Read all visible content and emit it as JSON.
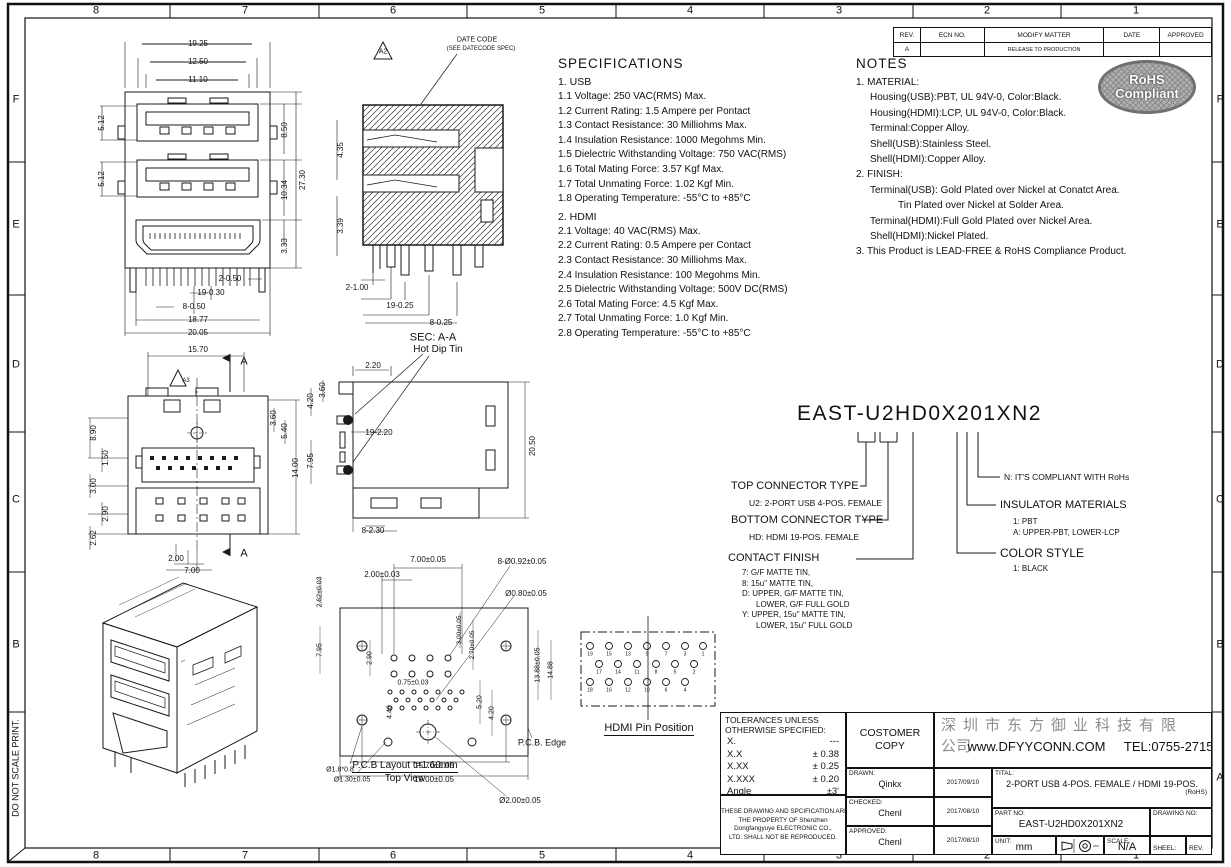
{
  "border": {
    "do_not_scale": "DO NOT SCALE PRINT.",
    "labels": [
      {
        "t": "8",
        "x": 96,
        "y": 11,
        "fs": 11
      },
      {
        "t": "7",
        "x": 245,
        "y": 11,
        "fs": 11
      },
      {
        "t": "6",
        "x": 393,
        "y": 11,
        "fs": 11
      },
      {
        "t": "5",
        "x": 542,
        "y": 11,
        "fs": 11
      },
      {
        "t": "4",
        "x": 690,
        "y": 11,
        "fs": 11
      },
      {
        "t": "3",
        "x": 839,
        "y": 11,
        "fs": 11
      },
      {
        "t": "2",
        "x": 987,
        "y": 11,
        "fs": 11
      },
      {
        "t": "1",
        "x": 1136,
        "y": 11,
        "fs": 11
      },
      {
        "t": "8",
        "x": 96,
        "y": 856,
        "fs": 11
      },
      {
        "t": "7",
        "x": 245,
        "y": 856,
        "fs": 11
      },
      {
        "t": "6",
        "x": 393,
        "y": 856,
        "fs": 11
      },
      {
        "t": "5",
        "x": 542,
        "y": 856,
        "fs": 11
      },
      {
        "t": "4",
        "x": 690,
        "y": 856,
        "fs": 11
      },
      {
        "t": "3",
        "x": 839,
        "y": 856,
        "fs": 11
      },
      {
        "t": "2",
        "x": 987,
        "y": 856,
        "fs": 11
      },
      {
        "t": "1",
        "x": 1136,
        "y": 856,
        "fs": 11
      },
      {
        "t": "F",
        "x": 16,
        "y": 100,
        "fs": 11
      },
      {
        "t": "E",
        "x": 16,
        "y": 225,
        "fs": 11
      },
      {
        "t": "D",
        "x": 16,
        "y": 365,
        "fs": 11
      },
      {
        "t": "C",
        "x": 16,
        "y": 500,
        "fs": 11
      },
      {
        "t": "B",
        "x": 16,
        "y": 645,
        "fs": 11
      },
      {
        "t": "F",
        "x": 1220,
        "y": 100,
        "fs": 11
      },
      {
        "t": "E",
        "x": 1220,
        "y": 225,
        "fs": 11
      },
      {
        "t": "D",
        "x": 1220,
        "y": 365,
        "fs": 11
      },
      {
        "t": "C",
        "x": 1220,
        "y": 500,
        "fs": 11
      },
      {
        "t": "B",
        "x": 1220,
        "y": 645,
        "fs": 11
      },
      {
        "t": "A",
        "x": 1220,
        "y": 778,
        "fs": 11
      },
      {
        "t": "DO NOT SCALE PRINT.",
        "x": 16,
        "y": 768,
        "r": -90,
        "fs": 9
      }
    ]
  },
  "revision_table": {
    "headers": [
      "REV.",
      "ECN NO.",
      "MODIFY  MATTER",
      "DATE",
      "APPROVED"
    ],
    "row": {
      "rev": "A",
      "ecn": "",
      "matter": "RELEASE TO PRODUCTION",
      "date": "",
      "approved": ""
    }
  },
  "specifications": {
    "title": "SPECIFICATIONS",
    "sections": [
      {
        "heading": "1. USB",
        "items": [
          "1.1 Voltage: 250 VAC(RMS) Max.",
          "1.2 Current Rating: 1.5 Ampere per Pontact",
          "1.3 Contact Resistance: 30 Milliohms Max.",
          "1.4 Insulation Resistance: 1000 Megohms Min.",
          "1.5 Dielectric Withstanding Voltage: 750 VAC(RMS)",
          "1.6 Total Mating Force: 3.57 Kgf Max.",
          "1.7 Total Unmating Force: 1.02 Kgf Min.",
          "1.8 Operating Temperature: -55°C to +85°C"
        ]
      },
      {
        "heading": "2. HDMI",
        "items": [
          "2.1 Voltage: 40 VAC(RMS) Max.",
          "2.2 Current Rating: 0.5 Ampere per Contact",
          "2.3 Contact Resistance: 30 Milliohms Max.",
          "2.4 Insulation Resistance: 100 Megohms Min.",
          "2.5 Dielectric Withstanding Voltage: 500V DC(RMS)",
          "2.6 Total Mating Force: 4.5 Kgf Max.",
          "2.7 Total Unmating Force: 1.0 Kgf Min.",
          "2.8 Operating Temperature: -55°C to +85°C"
        ]
      }
    ]
  },
  "notes": {
    "title": "NOTES",
    "items": [
      {
        "t": "1. MATERIAL:",
        "ind": 0
      },
      {
        "t": "Housing(USB):PBT, UL 94V-0, Color:Black.",
        "ind": 1
      },
      {
        "t": "Housing(HDMI):LCP, UL 94V-0, Color:Black.",
        "ind": 1
      },
      {
        "t": "Terminal:Copper Alloy.",
        "ind": 1
      },
      {
        "t": "Shell(USB):Stainless Steel.",
        "ind": 1
      },
      {
        "t": "Shell(HDMI):Copper Alloy.",
        "ind": 1
      },
      {
        "t": "2. FINISH:",
        "ind": 0
      },
      {
        "t": "Terminal(USB):  Gold Plated over Nickel at Conatct Area.",
        "ind": 1
      },
      {
        "t": "Tin Plated over Nickel at Solder Area.",
        "ind": 3
      },
      {
        "t": "Terminal(HDMI):Full Gold Plated over Nickel Area.",
        "ind": 1
      },
      {
        "t": "Shell(HDMI):Nickel Plated.",
        "ind": 1
      },
      {
        "t": "3. This Product is LEAD-FREE & RoHS Compliance Product.",
        "ind": 0
      }
    ]
  },
  "rohs_stamp": {
    "line1": "RoHS",
    "line2": "Compliant"
  },
  "part_number": {
    "value": "EAST-U2HD0X201XN2",
    "top_connector": {
      "label": "TOP CONNECTOR TYPE",
      "detail": "U2: 2-PORT USB 4-POS. FEMALE"
    },
    "bottom_connector": {
      "label": "BOTTOM CONNECTOR TYPE",
      "detail": "HD: HDMI 19-POS. FEMALE"
    },
    "contact_finish": {
      "label": "CONTACT FINISH",
      "options": [
        {
          "t": "7: G/F MATTE TIN,",
          "ind": 0
        },
        {
          "t": "8: 15u\" MATTE TIN,",
          "ind": 0
        },
        {
          "t": "D: UPPER, G/F MATTE TIN,",
          "ind": 0
        },
        {
          "t": "LOWER, G/F FULL GOLD",
          "ind": 1
        },
        {
          "t": "Y: UPPER, 15u\" MATTE TIN,",
          "ind": 0
        },
        {
          "t": "LOWER, 15u\" FULL GOLD",
          "ind": 1
        }
      ]
    },
    "rohs_note": "N: IT'S COMPLIANT WITH RoHs",
    "insulator": {
      "label": "INSULATOR MATERIALS",
      "options": [
        {
          "t": "1: PBT",
          "ind": 0
        },
        {
          "t": "A: UPPER-PBT, LOWER-LCP",
          "ind": 0
        }
      ]
    },
    "color_style": {
      "label": "COLOR STYLE",
      "options": [
        {
          "t": "1: BLACK",
          "ind": 0
        }
      ]
    }
  },
  "views": {
    "front": {
      "dims": [
        {
          "t": "19.25",
          "x": 118,
          "y": 14
        },
        {
          "t": "12.50",
          "x": 118,
          "y": 32
        },
        {
          "t": "11.10",
          "x": 118,
          "y": 50
        },
        {
          "t": "5.12",
          "x": 22,
          "y": 93,
          "r": -90
        },
        {
          "t": "5.12",
          "x": 22,
          "y": 149,
          "r": -90
        },
        {
          "t": "8.50",
          "x": 205,
          "y": 100,
          "r": -90
        },
        {
          "t": "10.34",
          "x": 205,
          "y": 160,
          "r": -90
        },
        {
          "t": "3.33",
          "x": 205,
          "y": 216,
          "r": -90
        },
        {
          "t": "27.30",
          "x": 223,
          "y": 150,
          "r": -90
        },
        {
          "t": "2-0.50",
          "x": 150,
          "y": 249
        },
        {
          "t": "19-0.30",
          "x": 131,
          "y": 263
        },
        {
          "t": "8-0.50",
          "x": 114,
          "y": 277
        },
        {
          "t": "18.77",
          "x": 118,
          "y": 290
        },
        {
          "t": "20.05",
          "x": 118,
          "y": 303
        }
      ]
    },
    "section": {
      "dims": [
        {
          "t": "A2",
          "x": 58,
          "y": 22,
          "fs": 7
        },
        {
          "t": "DATE CODE",
          "x": 152,
          "y": 10,
          "fs": 7
        },
        {
          "t": "(SEE DATECODE SPEC)",
          "x": 156,
          "y": 19,
          "fs": 6
        },
        {
          "t": "4.35",
          "x": 16,
          "y": 120,
          "r": -90
        },
        {
          "t": "3.39",
          "x": 16,
          "y": 196,
          "r": -90
        },
        {
          "t": "2-1.00",
          "x": 32,
          "y": 258
        },
        {
          "t": "19-0.25",
          "x": 75,
          "y": 276
        },
        {
          "t": "8-0.25",
          "x": 116,
          "y": 293
        },
        {
          "t": "SEC: A-A",
          "x": 108,
          "y": 308,
          "fs": 11
        }
      ]
    },
    "rear": {
      "dims": [
        {
          "t": "15.70",
          "x": 120,
          "y": 12
        },
        {
          "t": "A",
          "x": 166,
          "y": 24,
          "fs": 11
        },
        {
          "t": "A",
          "x": 166,
          "y": 216,
          "fs": 11
        },
        {
          "t": "A3",
          "x": 108,
          "y": 43,
          "fs": 6
        },
        {
          "t": "8.90",
          "x": 16,
          "y": 95,
          "r": -90
        },
        {
          "t": "1.50",
          "x": 28,
          "y": 120,
          "r": -90
        },
        {
          "t": "3.00",
          "x": 16,
          "y": 148,
          "r": -90
        },
        {
          "t": "2.90",
          "x": 28,
          "y": 176,
          "r": -90
        },
        {
          "t": "2.62",
          "x": 16,
          "y": 200,
          "r": -90
        },
        {
          "t": "3.60",
          "x": 196,
          "y": 80,
          "r": -90
        },
        {
          "t": "5.40",
          "x": 207,
          "y": 93,
          "r": -90
        },
        {
          "t": "14.00",
          "x": 218,
          "y": 130,
          "r": -90
        },
        {
          "t": "2.00",
          "x": 98,
          "y": 221
        },
        {
          "t": "7.00",
          "x": 114,
          "y": 233
        }
      ]
    },
    "side": {
      "dims": [
        {
          "t": "Hot Dip Tin",
          "x": 145,
          "y": 10,
          "fs": 10
        },
        {
          "t": "2.20",
          "x": 80,
          "y": 26
        },
        {
          "t": "3.60",
          "x": 30,
          "y": 50,
          "r": -90
        },
        {
          "t": "4.20",
          "x": 18,
          "y": 61,
          "r": -90
        },
        {
          "t": "19-2.20",
          "x": 86,
          "y": 93
        },
        {
          "t": "7.95",
          "x": 18,
          "y": 121,
          "r": -90
        },
        {
          "t": "20.50",
          "x": 240,
          "y": 106,
          "r": -90
        },
        {
          "t": "8-2.30",
          "x": 80,
          "y": 191
        }
      ]
    },
    "pcb": {
      "dims": [
        {
          "t": "7.00±0.05",
          "x": 118,
          "y": 10,
          "fs": 8
        },
        {
          "t": "2.00±0.03",
          "x": 72,
          "y": 25,
          "fs": 8
        },
        {
          "t": "8-Ø0.92±0.05",
          "x": 212,
          "y": 12,
          "fs": 8
        },
        {
          "t": "Ø0.80±0.05",
          "x": 216,
          "y": 44,
          "fs": 8
        },
        {
          "t": "2.62±0.03",
          "x": 10,
          "y": 42,
          "r": -90,
          "fs": 7
        },
        {
          "t": "7.95",
          "x": 10,
          "y": 100,
          "r": -90,
          "fs": 7
        },
        {
          "t": "2.90",
          "x": 60,
          "y": 108,
          "r": -90,
          "fs": 7
        },
        {
          "t": "3.00±0.05",
          "x": 150,
          "y": 80,
          "r": -90,
          "fs": 6.5
        },
        {
          "t": "2.70±0.05",
          "x": 163,
          "y": 95,
          "r": -90,
          "fs": 6.5
        },
        {
          "t": "0.75±0.03",
          "x": 103,
          "y": 133,
          "fs": 7
        },
        {
          "t": "4.40",
          "x": 80,
          "y": 162,
          "r": -90,
          "fs": 7
        },
        {
          "t": "13.88±0.05",
          "x": 228,
          "y": 115,
          "r": -90,
          "fs": 7
        },
        {
          "t": "14.88",
          "x": 241,
          "y": 120,
          "r": -90,
          "fs": 7
        },
        {
          "t": "5.20",
          "x": 170,
          "y": 152,
          "r": -90,
          "fs": 7
        },
        {
          "t": "4.20",
          "x": 182,
          "y": 163,
          "r": -90,
          "fs": 7
        },
        {
          "t": "15.70±0.05",
          "x": 124,
          "y": 216,
          "fs": 8
        },
        {
          "t": "19.00±0.05",
          "x": 124,
          "y": 230,
          "fs": 8
        },
        {
          "t": "Ø2.00±0.05",
          "x": 210,
          "y": 251,
          "fs": 8
        },
        {
          "t": "Ø1.8*0.8",
          "x": 30,
          "y": 220,
          "fs": 7
        },
        {
          "t": "Ø1.30±0.05",
          "x": 42,
          "y": 230,
          "fs": 7
        },
        {
          "t": "P.C.B. Edge",
          "x": 232,
          "y": 193,
          "fs": 9
        }
      ],
      "caption_line1": "P.C.B Layout t=1.60mm",
      "caption_line2": "Top View"
    },
    "hdmi_pins": {
      "dims": [
        {
          "t": "19",
          "x": 17,
          "y": 45,
          "fs": 5
        },
        {
          "t": "15",
          "x": 36,
          "y": 45,
          "fs": 5
        },
        {
          "t": "13",
          "x": 55,
          "y": 45,
          "fs": 5
        },
        {
          "t": "9",
          "x": 74,
          "y": 45,
          "fs": 5
        },
        {
          "t": "7",
          "x": 93,
          "y": 45,
          "fs": 5
        },
        {
          "t": "3",
          "x": 112,
          "y": 45,
          "fs": 5
        },
        {
          "t": "1",
          "x": 130,
          "y": 45,
          "fs": 5
        },
        {
          "t": "17",
          "x": 26,
          "y": 63,
          "fs": 5
        },
        {
          "t": "14",
          "x": 45,
          "y": 63,
          "fs": 5
        },
        {
          "t": "11",
          "x": 64,
          "y": 63,
          "fs": 5
        },
        {
          "t": "8",
          "x": 83,
          "y": 63,
          "fs": 5
        },
        {
          "t": "5",
          "x": 102,
          "y": 63,
          "fs": 5
        },
        {
          "t": "2",
          "x": 121,
          "y": 63,
          "fs": 5
        },
        {
          "t": "18",
          "x": 17,
          "y": 81,
          "fs": 5
        },
        {
          "t": "16",
          "x": 36,
          "y": 81,
          "fs": 5
        },
        {
          "t": "12",
          "x": 55,
          "y": 81,
          "fs": 5
        },
        {
          "t": "10",
          "x": 74,
          "y": 81,
          "fs": 5
        },
        {
          "t": "6",
          "x": 93,
          "y": 81,
          "fs": 5
        },
        {
          "t": "4",
          "x": 112,
          "y": 81,
          "fs": 5
        }
      ],
      "caption": "HDMI Pin Position"
    }
  },
  "title_block": {
    "tolerances": {
      "title_line1": "TOLERANCES UNLESS",
      "title_line2": "OTHERWISE SPECIFIED:",
      "rows": [
        {
          "k": "X.",
          "v": "---"
        },
        {
          "k": "X.X",
          "v": "± 0.38"
        },
        {
          "k": "X.XX",
          "v": "± 0.25"
        },
        {
          "k": "X.XXX",
          "v": "± 0.20"
        },
        {
          "k": "Angle",
          "v": "±3'"
        }
      ]
    },
    "property_note": [
      "THESE DRAWING AND SPCIFICATION ARE",
      "THE PROPERTY OF Shenzhen",
      "Dongfangyuye ELECTRONIC CO.,",
      "LTD. SHALL NOT BE REPRODUCED."
    ],
    "customer_copy_line1": "COSTOMER",
    "customer_copy_line2": "COPY",
    "signoff": {
      "rows": [
        {
          "label": "DRAWN:",
          "name": "Qinkx",
          "date": "2017/09/10"
        },
        {
          "label": "CHECKED:",
          "name": "Chenl",
          "date": "2017/08/10"
        },
        {
          "label": "APPROVED:",
          "name": "Chenl",
          "date": "2017/08/10"
        }
      ]
    },
    "company": {
      "name_cn": "深圳市东方御业科技有限",
      "name_cn2": "公司",
      "website": "www.DFYYCONN.COM",
      "tel": "TEL:0755-2715556"
    },
    "title_label": "TITAL:",
    "title_text": "2-PORT USB 4-POS. FEMALE / HDMI 19-POS.",
    "rohs_note": "(RoHS)",
    "part_no_label": "PART NO:",
    "part_no": "EAST-U2HD0X201XN2",
    "drawing_no_label": "DRAWING NO:",
    "unit_label": "UNIT:",
    "unit_value": "mm",
    "scale_label": "SCALE:",
    "scale_value": "N/A",
    "sheet_label": "SHEEL:",
    "rev_label": "REV."
  }
}
